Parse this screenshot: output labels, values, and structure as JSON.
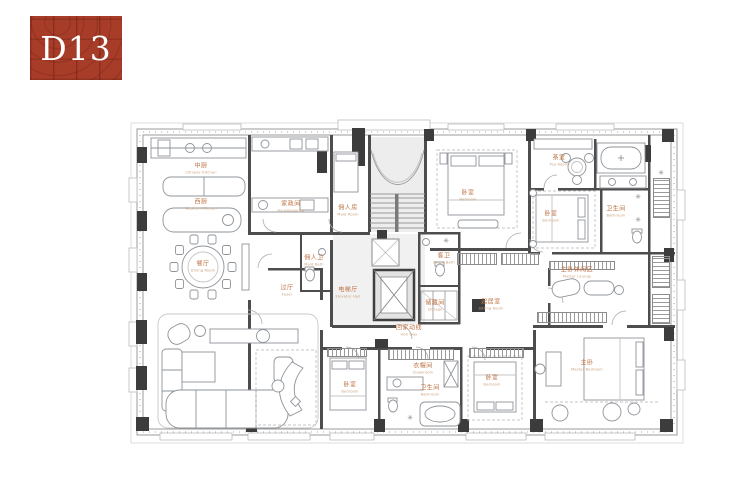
{
  "logo": {
    "text": "D13",
    "bg_color": "#a73d28",
    "text_color": "#ffffff"
  },
  "plan": {
    "label_color": "#bf7040",
    "wall_color": "#4d4d4d",
    "symbols": {
      "shower": "✳"
    },
    "rooms": {
      "kitchen_cn": {
        "cn": "中厨",
        "en": "Chinese Kitchen"
      },
      "kitchen_w": {
        "cn": "西厨",
        "en": "Western Kitchen"
      },
      "dining": {
        "cn": "餐厅",
        "en": "Dining Room"
      },
      "housekeeping": {
        "cn": "家政间",
        "en": "Housekeeping"
      },
      "maid": {
        "cn": "佣人房",
        "en": "Maid Room"
      },
      "maid_bath": {
        "cn": "佣人卫",
        "en": "Maid Bath"
      },
      "foyer": {
        "cn": "过厅",
        "en": "Foyer"
      },
      "elevator_hall": {
        "cn": "电梯厅",
        "en": "Elevator Hall"
      },
      "hallway": {
        "cn": "回家动线",
        "en": "Hall Way"
      },
      "bedroom_n": {
        "cn": "卧室",
        "en": "Bedroom"
      },
      "guest_bath": {
        "cn": "客卫",
        "en": "Guest Bath"
      },
      "storage": {
        "cn": "储藏间",
        "en": "Storage"
      },
      "tea": {
        "cn": "茶室",
        "en": "Tea Room"
      },
      "bedroom_e": {
        "cn": "卧室",
        "en": "Bedroom"
      },
      "bath_e": {
        "cn": "卫生间",
        "en": "Bathroom"
      },
      "family": {
        "cn": "起居室",
        "en": "Sitting Room"
      },
      "master_lounge": {
        "cn": "主卧休闲区",
        "en": "Master Lounge"
      },
      "closet_s": {
        "cn": "衣帽间",
        "en": "Cloakroom"
      },
      "bath_s": {
        "cn": "卫生间",
        "en": "Bathroom"
      },
      "bedroom_sw": {
        "cn": "卧室",
        "en": "Bedroom"
      },
      "bedroom_s": {
        "cn": "卧室",
        "en": "Bedroom"
      },
      "master": {
        "cn": "主卧",
        "en": "Master Bedroom"
      }
    }
  }
}
